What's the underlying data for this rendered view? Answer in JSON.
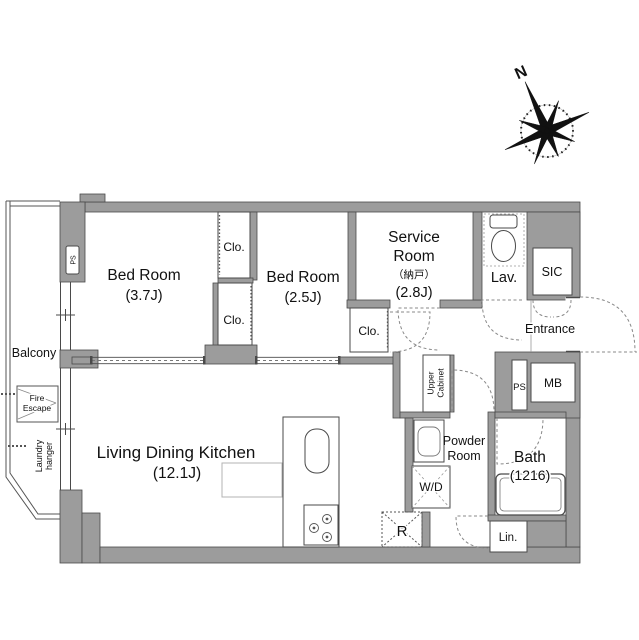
{
  "colors": {
    "wall_fill": "#9c9c9c",
    "wall_outline": "#4a4a4a",
    "dash_line": "#808080",
    "text": "#111111"
  },
  "compass": {
    "north": "N"
  },
  "balcony": {
    "label": "Balcony",
    "fire_escape1": "Fire",
    "fire_escape2": "Escape",
    "laundry1": "Laundry",
    "laundry2": "hanger"
  },
  "rooms": {
    "bedroom_a": {
      "name": "Bed Room",
      "size": "(3.7J)"
    },
    "bedroom_b": {
      "name": "Bed Room",
      "size": "(2.5J)"
    },
    "service_room": {
      "name1": "Service",
      "name2": "Room",
      "kanji": "（納戸）",
      "size": "(2.8J)"
    },
    "ldk": {
      "name": "Living Dining Kitchen",
      "size": "(12.1J)"
    },
    "bath": {
      "name": "Bath",
      "size": "(1216)"
    },
    "powder_room": {
      "name1": "Powder",
      "name2": "Room"
    },
    "lav": {
      "label": "Lav."
    },
    "sic": {
      "label": "SIC"
    },
    "entrance": {
      "label": "Entrance"
    }
  },
  "fixtures": {
    "closet": "Clo.",
    "washer_dryer": "W/D",
    "refrigerator": "R",
    "linen": "Lin.",
    "meter_box": "MB",
    "pipe_space": "PS",
    "upper_cabinet1": "Upper",
    "upper_cabinet2": "Cabinet"
  }
}
